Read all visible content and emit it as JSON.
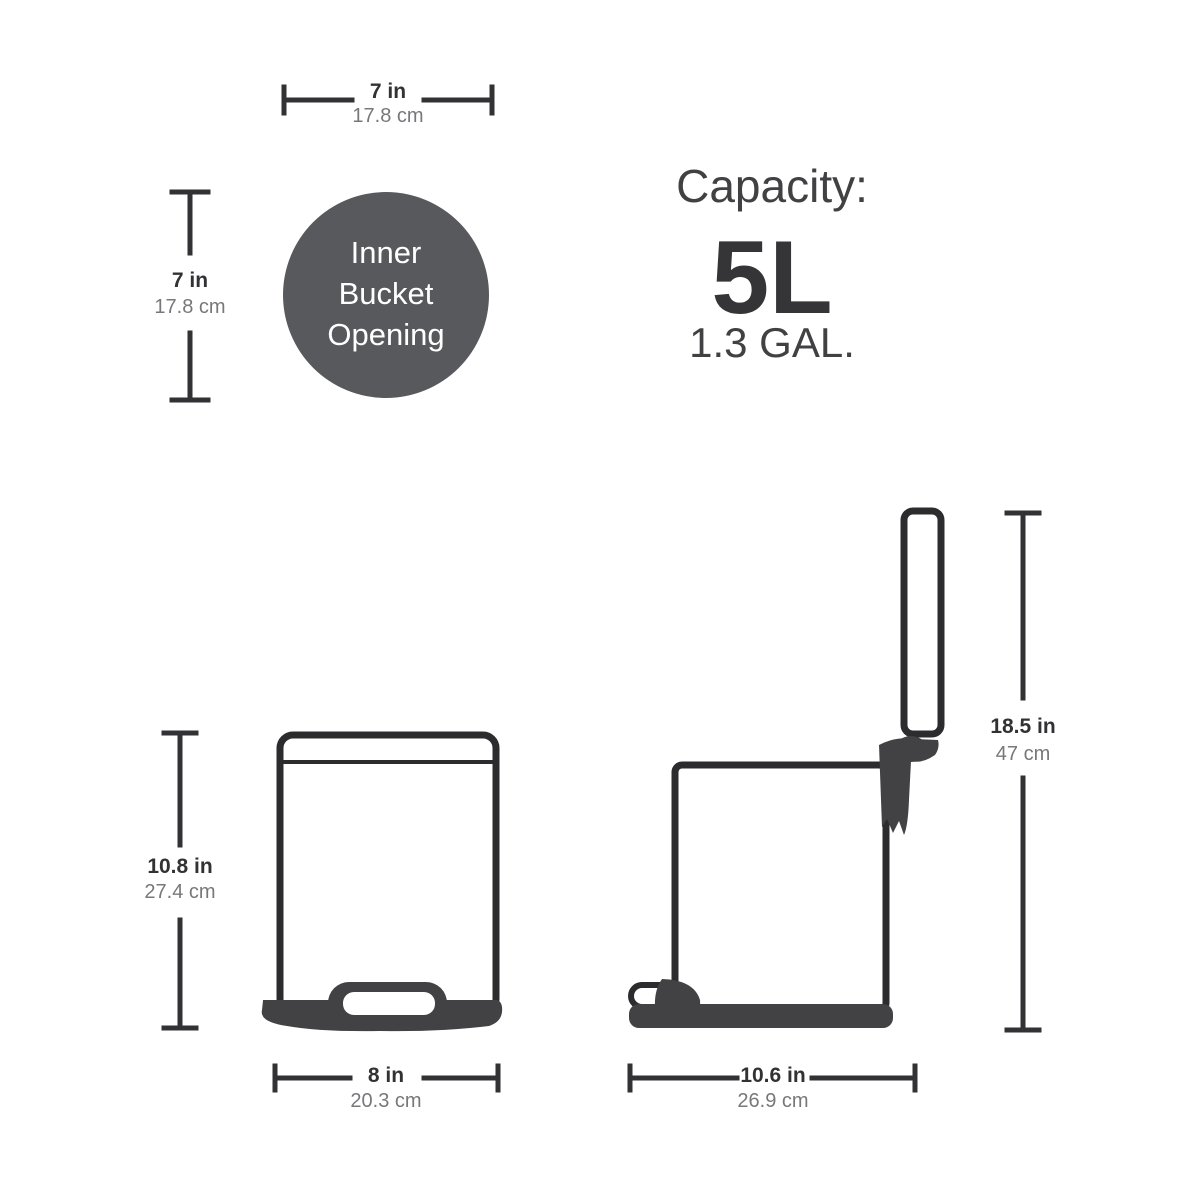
{
  "colors": {
    "background": "#ffffff",
    "line_dark": "#2c2c2e",
    "dimension_line": "#323234",
    "inch_label": "#323234",
    "cm_label": "#77787b",
    "dark_fill": "#424245",
    "circle_fill": "#58595c",
    "circle_text": "#ffffff",
    "capacity_text": "#414143"
  },
  "inner_bucket_opening": {
    "label_lines": [
      "Inner",
      "Bucket",
      "Opening"
    ],
    "width": {
      "in": "7 in",
      "cm": "17.8 cm"
    },
    "height": {
      "in": "7 in",
      "cm": "17.8 cm"
    }
  },
  "capacity": {
    "title": "Capacity:",
    "liters": "5L",
    "gallons": "1.3 GAL."
  },
  "front_view": {
    "height": {
      "in": "10.8 in",
      "cm": "27.4 cm"
    },
    "width": {
      "in": "8 in",
      "cm": "20.3 cm"
    }
  },
  "side_view": {
    "height": {
      "in": "18.5 in",
      "cm": "47 cm"
    },
    "depth": {
      "in": "10.6 in",
      "cm": "26.9 cm"
    }
  }
}
